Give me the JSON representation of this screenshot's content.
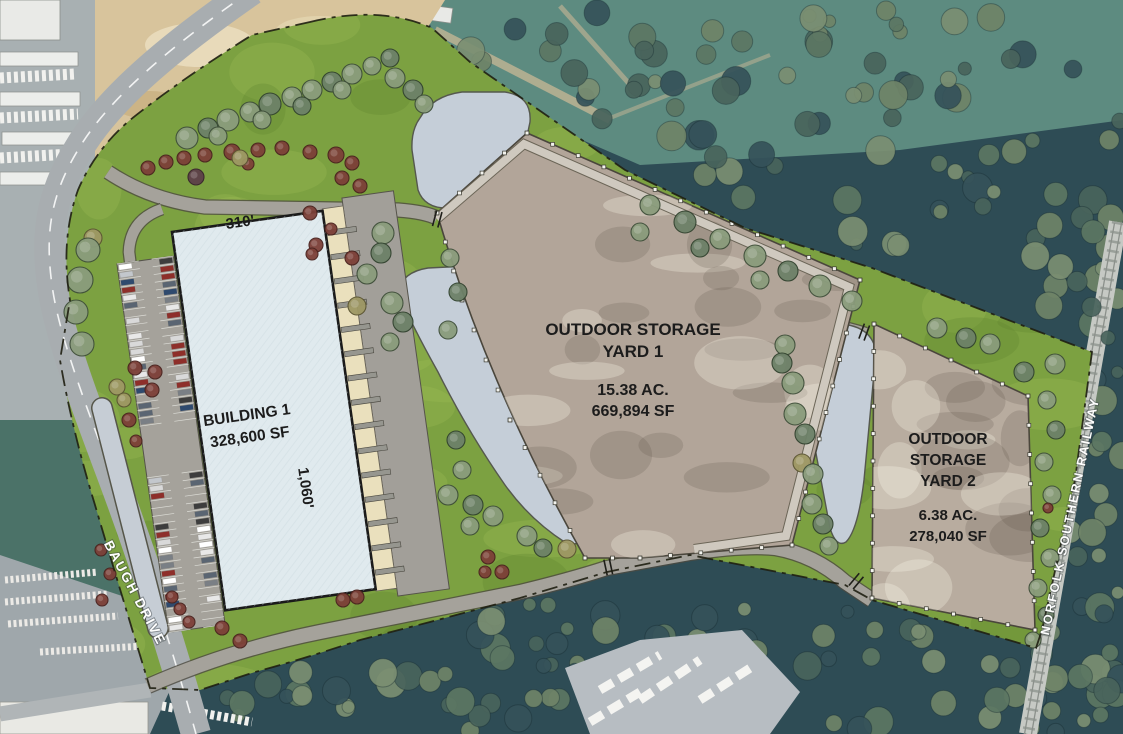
{
  "plan": {
    "building1": {
      "name": "BUILDING 1",
      "area": "328,600 SF",
      "width_label": "310'",
      "depth_label": "1,060'"
    },
    "yard1": {
      "title1": "OUTDOOR STORAGE",
      "title2": "YARD 1",
      "acreage": "15.38 AC.",
      "area": "669,894 SF"
    },
    "yard2": {
      "title1": "OUTDOOR",
      "title2": "STORAGE",
      "title3": "YARD 2",
      "acreage": "6.38 AC.",
      "area": "278,040 SF"
    },
    "labels": {
      "baugh_drive": "BAUGH DRIVE",
      "railway": "NORFOLK SOUTHERN RAILWAY"
    },
    "colors": {
      "site_green": "#7ca141",
      "yard_surface": "#b2a599",
      "pond": "#c5ced8",
      "building_fill": "#e0eaee",
      "dock_apron": "#eae0bd",
      "truck_court": "#a29f99",
      "forest": "#2e4c55",
      "dirt": "#d8c49c",
      "road": "#a8adb0",
      "label_text": "#1c1c1c",
      "road_label_text": "#ffffff"
    }
  }
}
